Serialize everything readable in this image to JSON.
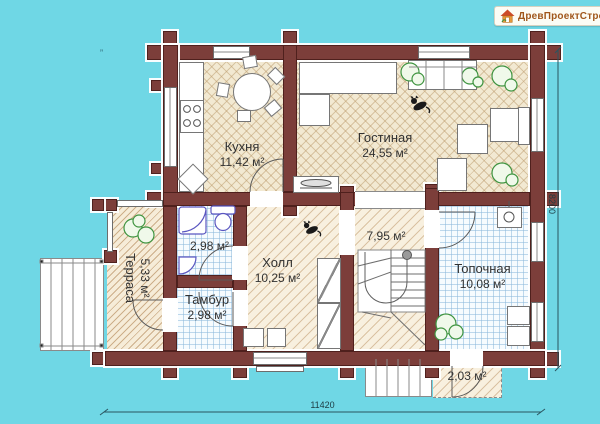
{
  "app": {
    "logo_text": "ДревПроектСтрой"
  },
  "rooms": [
    {
      "id": "kitchen",
      "name": "Кухня",
      "area": "11,42 м²"
    },
    {
      "id": "living",
      "name": "Гостиная",
      "area": "24,55 м²"
    },
    {
      "id": "terrace",
      "name": "Терраса",
      "area": "5,33 м²"
    },
    {
      "id": "bathroom",
      "name": "",
      "area": "2,98 м²"
    },
    {
      "id": "tambour",
      "name": "Тамбур",
      "area": "2,98 м²"
    },
    {
      "id": "hall",
      "name": "Холл",
      "area": "10,25 м²"
    },
    {
      "id": "stair_hall",
      "name": "",
      "area": "7,95 м²"
    },
    {
      "id": "boiler",
      "name": "Топочная",
      "area": "10,08 м²"
    },
    {
      "id": "porch",
      "name": "",
      "area": "2,03 м²"
    }
  ],
  "dimensions": {
    "overall_width_mm": "11420",
    "overall_depth_mm": "8200"
  },
  "annotations": {
    "stray_mark": "”"
  },
  "colors": {
    "background": "#6fd7e5",
    "walls": "#7c3e3a",
    "plumbing_accent": "#5a56c0",
    "parquet_floor": "#f2e9d2",
    "tile_floor": "#f6fbfe",
    "hatch_floor": "#f8f0df",
    "plant_green": "#3f9440"
  }
}
